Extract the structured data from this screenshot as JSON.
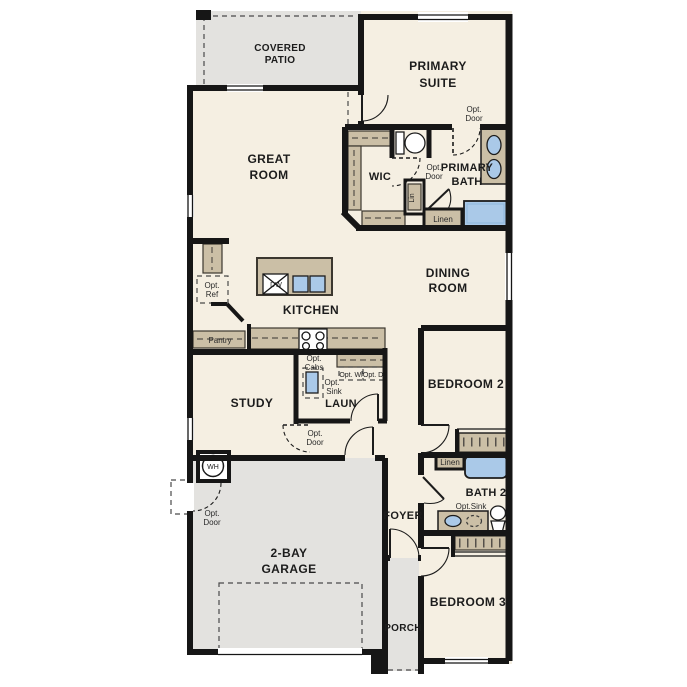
{
  "canvas": {
    "width": 687,
    "height": 687,
    "type": "single-story floor plan"
  },
  "colors": {
    "background": "#ffffff",
    "wall": "#161616",
    "floor_interior": "#f5efe2",
    "floor_exterior_gray": "#e3e2df",
    "cabinet_tan": "#cbbfa6",
    "fixture_blue": "#aac9e8",
    "optional_item_gray": "#ececec"
  },
  "rooms": {
    "covered_patio": {
      "line1": "COVERED",
      "line2": "PATIO"
    },
    "primary_suite": {
      "line1": "PRIMARY",
      "line2": "SUITE"
    },
    "great_room": {
      "line1": "GREAT",
      "line2": "ROOM"
    },
    "primary_bath": {
      "line1": "PRIMARY",
      "line2": "BATH"
    },
    "wic": {
      "label": "WIC"
    },
    "dining_room": {
      "line1": "DINING",
      "line2": "ROOM"
    },
    "kitchen": {
      "label": "KITCHEN"
    },
    "study": {
      "label": "STUDY"
    },
    "laundry": {
      "label": "LAUN"
    },
    "bedroom2": {
      "label": "BEDROOM 2"
    },
    "bath2": {
      "label": "BATH 2"
    },
    "foyer": {
      "label": "FOYER"
    },
    "garage": {
      "line1": "2-BAY",
      "line2": "GARAGE"
    },
    "porch": {
      "label": "PORCH"
    },
    "bedroom3": {
      "label": "BEDROOM 3"
    }
  },
  "annotations": {
    "opt_door": {
      "line1": "Opt.",
      "line2": "Door"
    },
    "opt_ref": {
      "line1": "Opt.",
      "line2": "Ref"
    },
    "opt_cabs": {
      "line1": "Opt.",
      "line2": "Cabs"
    },
    "opt_sink": {
      "line1": "Opt.",
      "line2": "Sink"
    },
    "opt_sink_inline": "Opt.Sink",
    "opt_washer": "Opt. W.",
    "opt_dryer": "Opt. D.",
    "pantry": "Pantry",
    "linen": "Linen",
    "lin": "Lin",
    "dishwasher": "DW",
    "water_heater": "WH"
  }
}
